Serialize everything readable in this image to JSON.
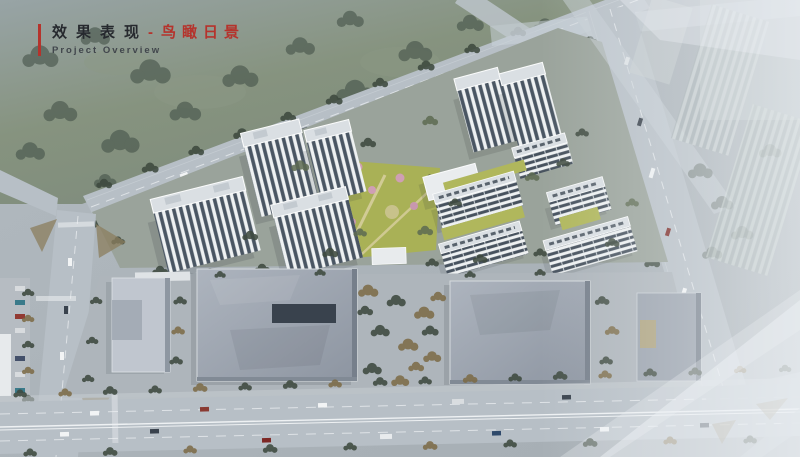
{
  "header": {
    "title_zh": "效果表现",
    "separator": "-",
    "title_accent_zh": "鸟瞰日景",
    "subtitle_en": "Project Overview"
  },
  "scene": {
    "alt": "Aerial daytime bird's-eye rendering: residential towers and slab apartments with green roofs around a landscaped park, flat-roof commercial halls along the south boulevard, tree-lined roads, major intersections, hazy ghost buildings to the east",
    "palette": {
      "accent_red": "#b5332c",
      "title_dark": "#26292e",
      "subtitle_gray": "#41464c",
      "field_green": "#7e8b7e",
      "tree_dark": "#3e4a3f",
      "tree_autumn": "#7c6a45",
      "road_gray": "#b7bfc6",
      "lane_white": "#e8ecee",
      "parcel_ground": "#9aa39b",
      "commercial_ground": "#aeb5bb",
      "facade_white": "#f1f3f4",
      "window_dark": "#4a5663",
      "roof_light": "#dadfe3",
      "green_roof": "#b0b75c",
      "park_green": "#a9b156",
      "blossom_pink": "#cf9fb4",
      "commercial_gray": "#9aa2ad",
      "commercial_shadow": "#767f8b",
      "courtyard_dark": "#39424d",
      "island_tan": "#8b7d5e",
      "haze_white": "#edf1f4"
    }
  }
}
